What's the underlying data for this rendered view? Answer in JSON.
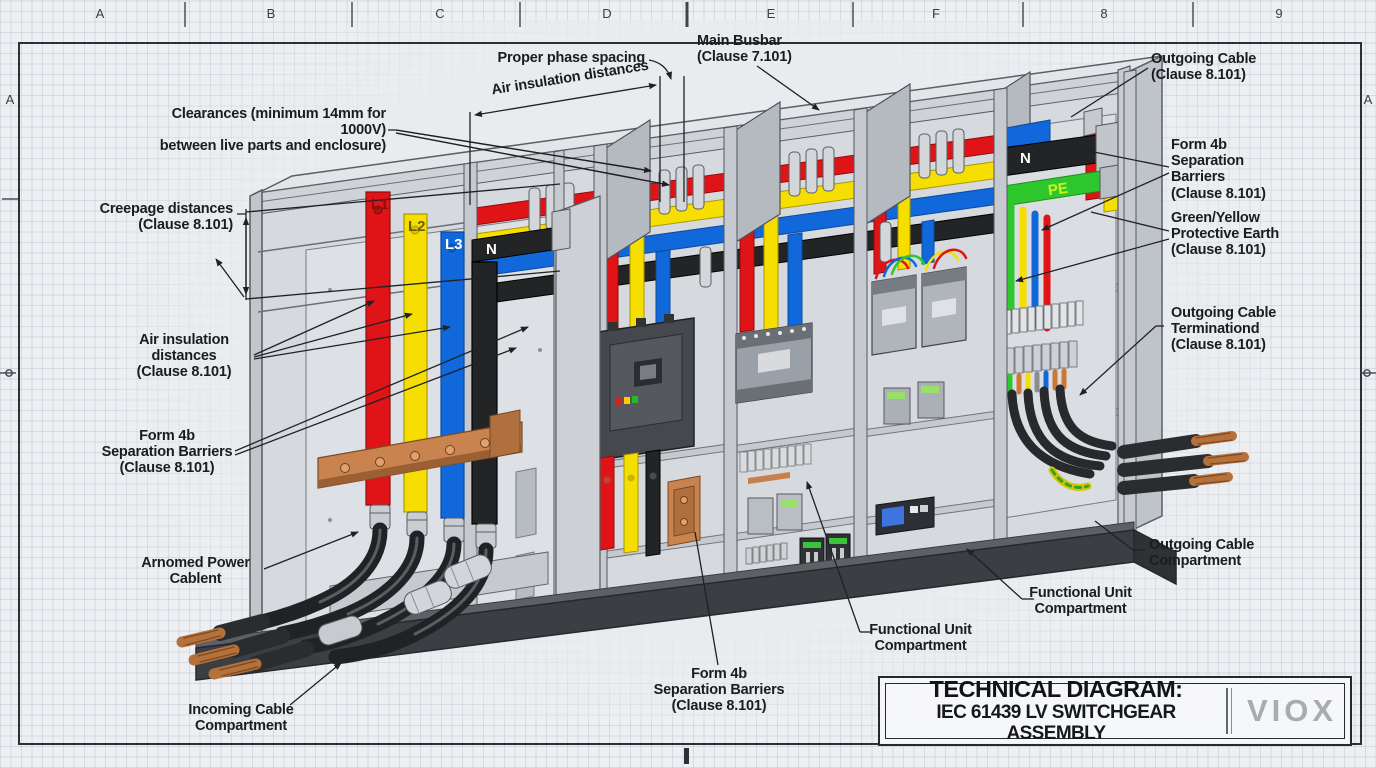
{
  "sheet": {
    "refs_top": [
      "A",
      "B",
      "C",
      "D",
      "E",
      "F",
      "8",
      "9"
    ],
    "ref_side": "A"
  },
  "title_block": {
    "title": "TECHNICAL DIAGRAM:",
    "subtitle": "IEC 61439 LV SWITCHGEAR ASSEMBLY",
    "logo": "VIOX"
  },
  "busbar_labels": {
    "l1": "L1",
    "l2": "L2",
    "l3": "L3",
    "n_incoming": "N",
    "n_outgoing": "N",
    "pe": "PE"
  },
  "annotations": {
    "proper_phase_spacing": {
      "text": "Proper phase spacing"
    },
    "air_insulation_top": {
      "text": "Air insulation distances"
    },
    "main_busbar": {
      "text": "Main Busbar\n(Clause 7.101)"
    },
    "outgoing_cable_top": {
      "text": "Outgoing Cable\n(Clause 8.101)"
    },
    "clearances": {
      "text": "Clearances (minimum 14mm for 1000V)\nbetween live parts and enclosure)"
    },
    "creepage": {
      "text": "Creepage distances\n(Clause 8.101)"
    },
    "form4b_right": {
      "text": "Form 4b\nSeparation\nBarriers\n(Clause 8.101)"
    },
    "green_yellow_pe": {
      "text": "Green/Yellow\nProtective Earth\n(Clause 8.101)"
    },
    "outgoing_termination": {
      "text": "Outgoing Cable\nTerminationd\n(Clause 8.101)"
    },
    "air_insulation_left": {
      "text": "Air insulation\ndistances\n(Clause 8.101)"
    },
    "form4b_left": {
      "text": "Form 4b\nSeparation Barriers\n(Clause 8.101)"
    },
    "armored_cable": {
      "text": "Arnomed Power\nCablent"
    },
    "outgoing_compartment": {
      "text": "Outgoing Cable\nCompartment"
    },
    "functional_unit_right": {
      "text": "Functional Unit\nCompartment"
    },
    "functional_unit_center": {
      "text": "Functional Unit\nCompartment"
    },
    "incoming_compartment": {
      "text": "Incoming Cable\nCompartment"
    },
    "form4b_bottom": {
      "text": "Form 4b\nSeparation Barriers\n(Clause 8.101)"
    }
  },
  "colors": {
    "phase_l1_red": "#e01417",
    "phase_l2_yellow": "#f6df00",
    "phase_l3_blue": "#1168db",
    "neutral_black": "#232426",
    "pe_green": "#2ec82e",
    "copper": "#c9834e",
    "enclosure_gray": "#d6d9dd",
    "plinth_dark": "#3b3e42"
  }
}
